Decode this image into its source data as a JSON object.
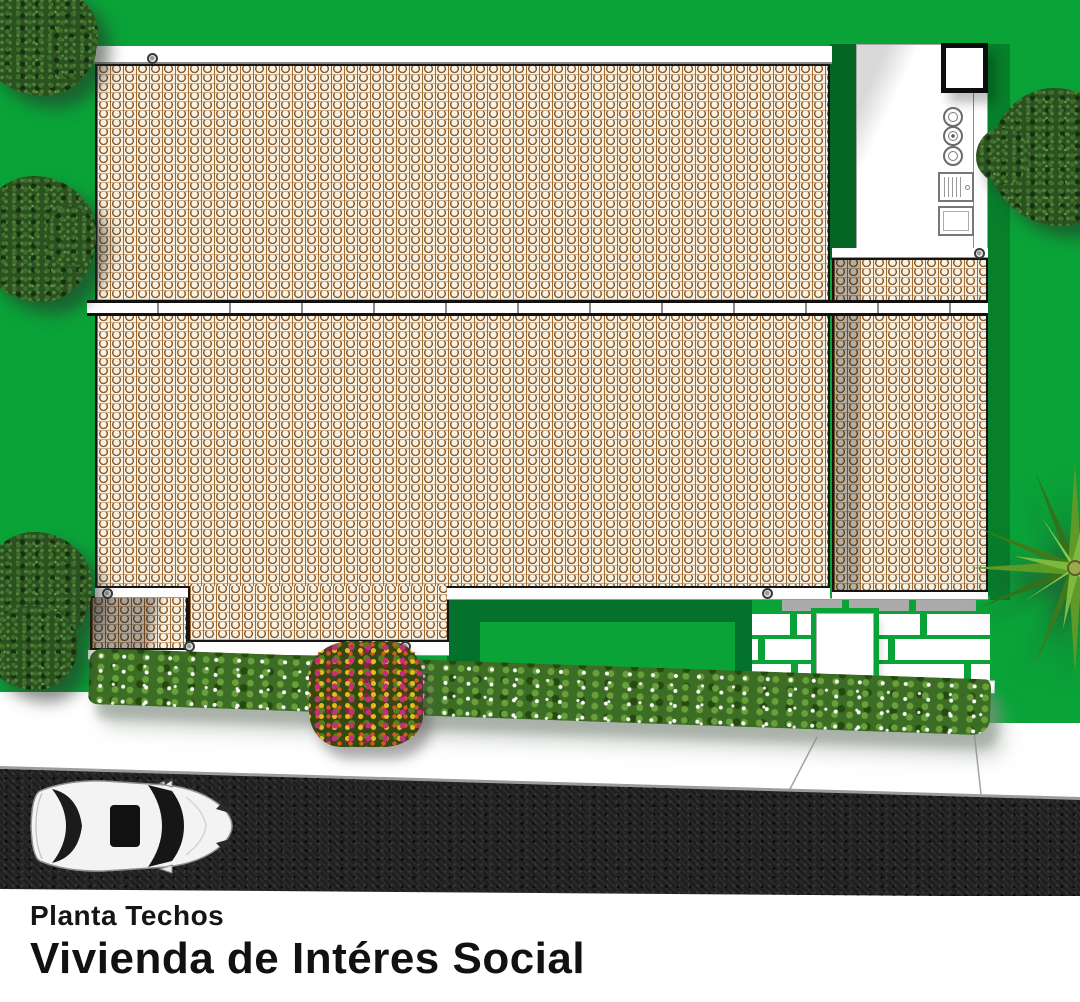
{
  "title_block": {
    "subtitle": "Planta Techos",
    "title": "Vivienda de Intéres Social"
  },
  "palette": {
    "grass_green": "#09A338",
    "shadow_green": "#03702B",
    "roof_tile_cream": "#F8F2E4",
    "roof_tile_brown": "#8D5A28",
    "ridge_white": "#FFFFFF",
    "outline_black": "#141414",
    "road_asphalt": "#1F1F1F",
    "sidewalk_white": "#FFFFFF",
    "paver_joint_green": "#09A338",
    "hedge_green": "#3B6D24",
    "flower_white": "#FFFFFF",
    "flower_magenta": "#C23078",
    "flower_yellow": "#E5BB22",
    "car_body_white": "#F3F3F3"
  }
}
